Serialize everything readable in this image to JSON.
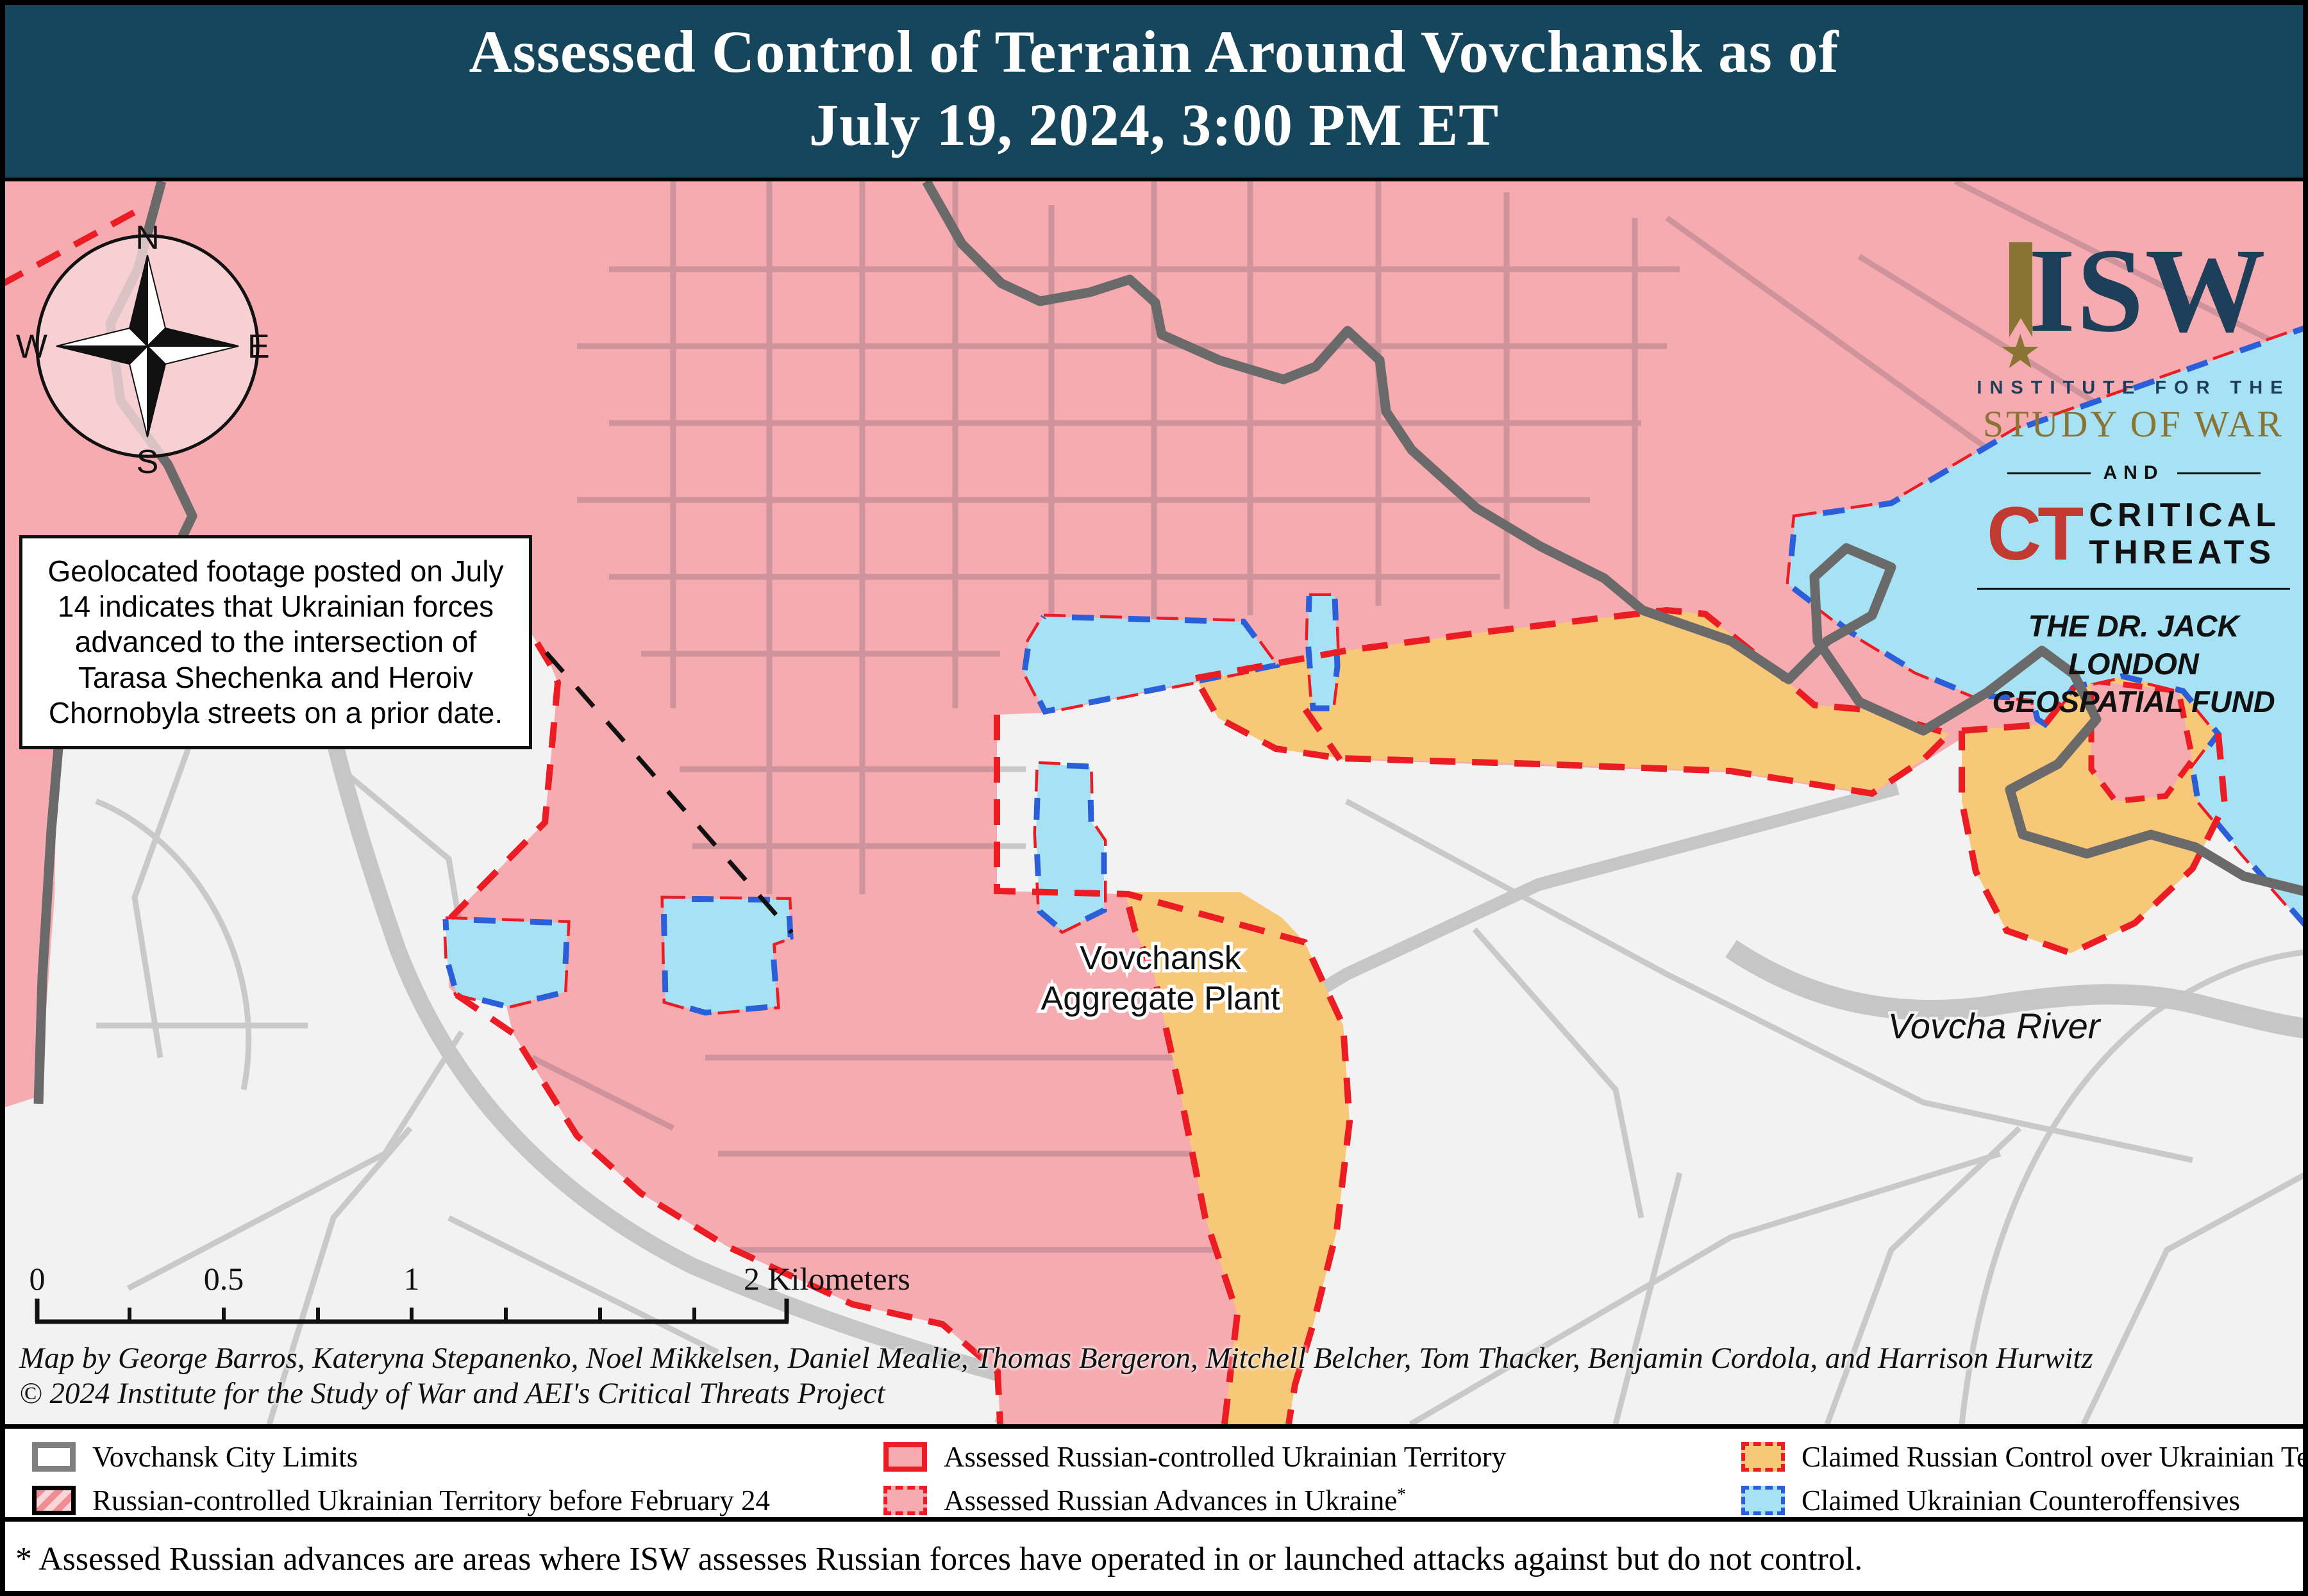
{
  "title": {
    "line1": "Assessed Control of Terrain Around Vovchansk as of",
    "line2": "July 19, 2024, 3:00 PM ET"
  },
  "annotation": {
    "text": "Geolocated footage posted on July 14 indicates that Ukrainian forces advanced to the intersection of Tarasa Shechenka and Heroiv Chornobyla streets on a prior date."
  },
  "compass": {
    "north": "N",
    "east": "E",
    "south": "S",
    "west": "W"
  },
  "logo": {
    "isw": "ISW",
    "star": "★",
    "institute": "INSTITUTE FOR THE",
    "study": "STUDY OF WAR",
    "and": "AND",
    "ct": "CT",
    "critical": "CRITICAL",
    "threats": "THREATS",
    "fund_line1": "THE DR. JACK LONDON",
    "fund_line2": "GEOSPATIAL FUND"
  },
  "map_labels": {
    "plant_line1": "Vovchansk",
    "plant_line2": "Aggregate Plant",
    "river": "Vovcha River"
  },
  "scale_bar": {
    "labels": [
      "0",
      "0.5",
      "1",
      "2 Kilometers"
    ]
  },
  "credits": {
    "line1": "Map by George Barros, Kateryna Stepanenko, Noel Mikkelsen, Daniel Mealie, Thomas Bergeron, Mitchell Belcher, Tom Thacker, Benjamin Cordola, and Harrison Hurwitz",
    "line2": "© 2024 Institute for the Study of War and AEI's Critical Threats Project"
  },
  "legend": {
    "asterisk": "*",
    "items": [
      {
        "label": "Vovchansk City Limits"
      },
      {
        "label": "Russian-controlled Ukrainian Territory before February 24"
      },
      {
        "label": "Assessed Russian-controlled Ukrainian Territory"
      },
      {
        "label": "Assessed Russian Advances in Ukraine"
      },
      {
        "label": "Claimed Russian Control over Ukrainian Territory"
      },
      {
        "label": "Claimed Ukrainian Counteroffensives"
      }
    ]
  },
  "footnote": "* Assessed Russian advances are areas where ISW assesses Russian forces have operated in or launched attacks against but do not control.",
  "colors": {
    "header_bg": "#15465c",
    "russian_controlled": "#f5abb0",
    "claimed_russian": "#f7c878",
    "claimed_ukrainian": "#a6e1f4",
    "no_control": "#f2f2f2",
    "frontline_red": "#ec1c24",
    "counter_blue": "#2b5fd9",
    "city_limits_gray": "#6a6a6a"
  }
}
